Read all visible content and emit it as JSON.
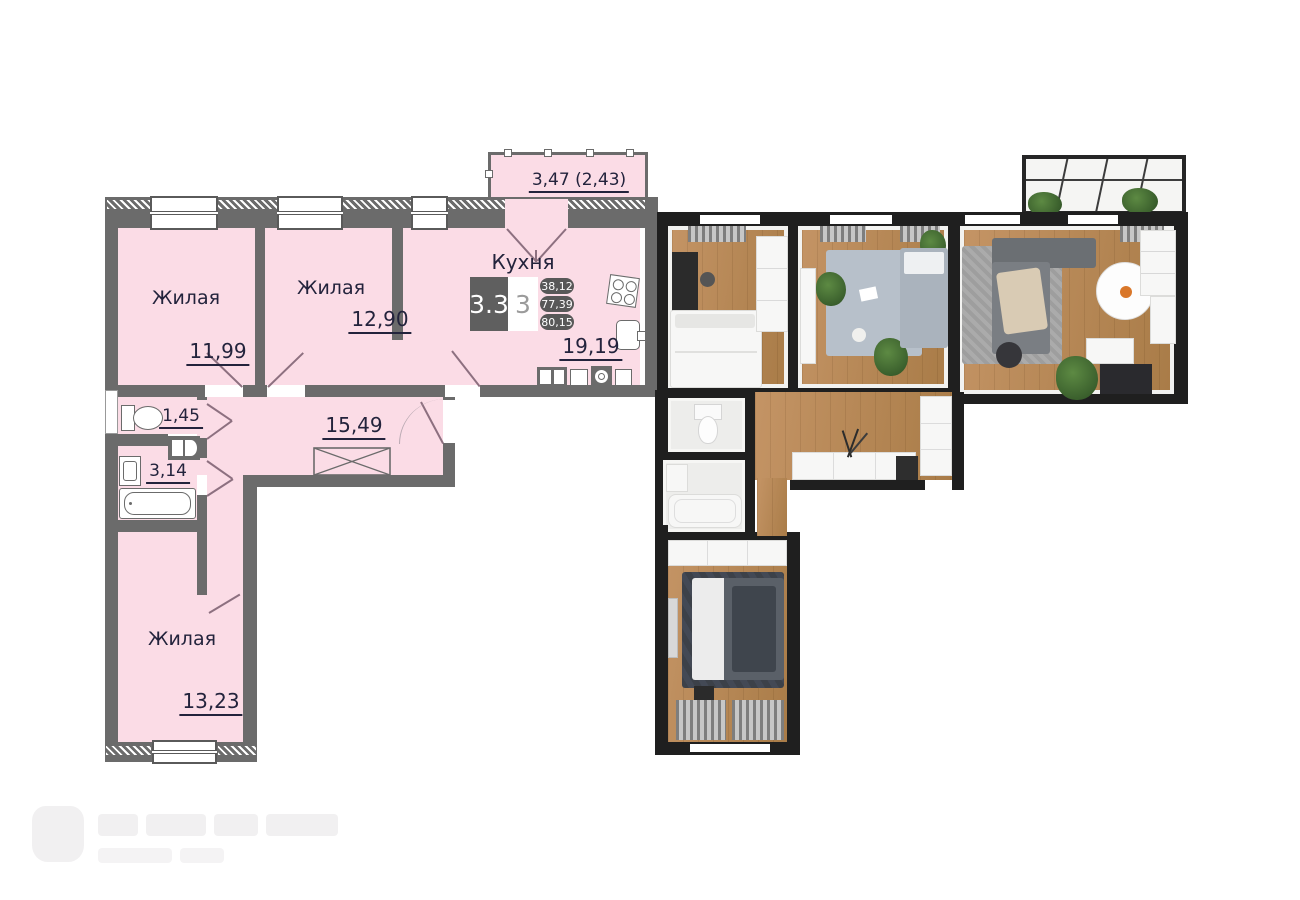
{
  "plan2d": {
    "rooms": {
      "living1": {
        "label": "Жилая",
        "area": "11,99"
      },
      "living2": {
        "label": "Жилая",
        "area": "12,90"
      },
      "kitchen": {
        "label": "Кухня",
        "area": "19,19"
      },
      "wc": {
        "area": "1,45"
      },
      "bathroom": {
        "area": "3,14"
      },
      "hallway": {
        "area": "15,49"
      },
      "living3": {
        "label": "Жилая",
        "area": "13,23"
      }
    },
    "balcony": {
      "area": "3,47 (2,43)"
    },
    "info_badge": {
      "layout_code": "3.3",
      "room_count": "3",
      "areas": [
        "38,12",
        "77,39",
        "80,15"
      ]
    },
    "fixtures": [
      "toilet",
      "water-heater",
      "wash-basin",
      "bathtub",
      "stove",
      "kitchen-sink",
      "fridge",
      "washing-machine",
      "wardrobe-cross",
      "entrance-door"
    ],
    "colors": {
      "room_fill": "#fbdce6",
      "wall": "#6b6b6b",
      "text": "#23233c"
    }
  },
  "render3d": {
    "style": "top-down-3d-render",
    "rooms": [
      "bedroom-1",
      "bedroom-2",
      "living-kitchen",
      "hallway",
      "wc",
      "bathroom",
      "bedroom-3",
      "glass-balcony"
    ]
  }
}
